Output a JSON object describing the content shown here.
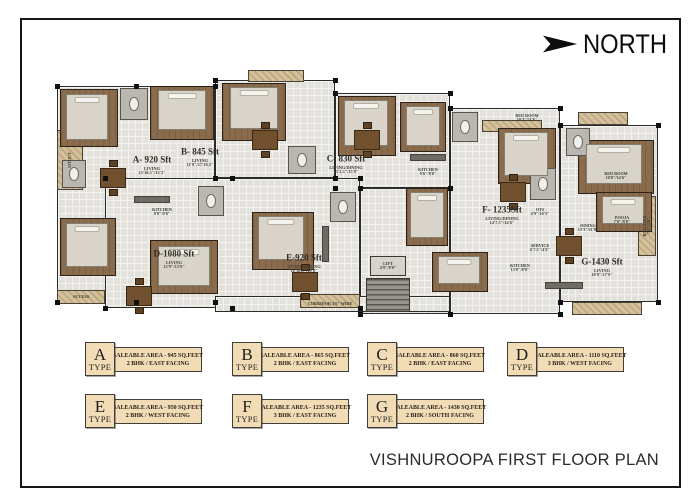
{
  "north": {
    "label": "NORTH"
  },
  "title": "VISHNUROOPA FIRST FLOOR PLAN",
  "plan": {
    "slabs": [
      {
        "x": 57,
        "y": 86,
        "w": 158,
        "h": 216
      },
      {
        "x": 215,
        "y": 80,
        "w": 120,
        "h": 98
      },
      {
        "x": 335,
        "y": 93,
        "w": 115,
        "h": 95
      },
      {
        "x": 105,
        "y": 178,
        "w": 255,
        "h": 130
      },
      {
        "x": 360,
        "y": 188,
        "w": 90,
        "h": 126
      },
      {
        "x": 450,
        "y": 108,
        "w": 110,
        "h": 206
      },
      {
        "x": 560,
        "y": 125,
        "w": 98,
        "h": 177
      }
    ],
    "corridor": {
      "x": 215,
      "y": 296,
      "w": 235,
      "h": 16
    },
    "balconies": [
      {
        "x": 57,
        "y": 130,
        "w": 26,
        "h": 60
      },
      {
        "x": 57,
        "y": 290,
        "w": 48,
        "h": 14
      },
      {
        "x": 248,
        "y": 70,
        "w": 56,
        "h": 12
      },
      {
        "x": 300,
        "y": 294,
        "w": 60,
        "h": 14
      },
      {
        "x": 572,
        "y": 302,
        "w": 70,
        "h": 13
      },
      {
        "x": 638,
        "y": 196,
        "w": 18,
        "h": 60
      },
      {
        "x": 482,
        "y": 120,
        "w": 60,
        "h": 12
      },
      {
        "x": 578,
        "y": 112,
        "w": 50,
        "h": 13
      }
    ],
    "bedrooms": [
      {
        "x": 60,
        "y": 89,
        "w": 58,
        "h": 58
      },
      {
        "x": 150,
        "y": 86,
        "w": 64,
        "h": 54
      },
      {
        "x": 222,
        "y": 83,
        "w": 64,
        "h": 58
      },
      {
        "x": 338,
        "y": 96,
        "w": 58,
        "h": 60
      },
      {
        "x": 400,
        "y": 102,
        "w": 46,
        "h": 50
      },
      {
        "x": 498,
        "y": 128,
        "w": 58,
        "h": 56
      },
      {
        "x": 578,
        "y": 140,
        "w": 76,
        "h": 54
      },
      {
        "x": 60,
        "y": 218,
        "w": 56,
        "h": 58
      },
      {
        "x": 150,
        "y": 240,
        "w": 68,
        "h": 54
      },
      {
        "x": 252,
        "y": 212,
        "w": 62,
        "h": 58
      },
      {
        "x": 406,
        "y": 188,
        "w": 42,
        "h": 58
      },
      {
        "x": 432,
        "y": 252,
        "w": 56,
        "h": 40
      },
      {
        "x": 596,
        "y": 192,
        "w": 56,
        "h": 40
      }
    ],
    "beds": [
      {
        "x": 66,
        "y": 94,
        "w": 42,
        "h": 46
      },
      {
        "x": 158,
        "y": 90,
        "w": 48,
        "h": 40
      },
      {
        "x": 230,
        "y": 87,
        "w": 48,
        "h": 42
      },
      {
        "x": 344,
        "y": 100,
        "w": 44,
        "h": 46
      },
      {
        "x": 406,
        "y": 106,
        "w": 34,
        "h": 40
      },
      {
        "x": 504,
        "y": 132,
        "w": 44,
        "h": 44
      },
      {
        "x": 586,
        "y": 144,
        "w": 56,
        "h": 40
      },
      {
        "x": 66,
        "y": 223,
        "w": 42,
        "h": 44
      },
      {
        "x": 158,
        "y": 246,
        "w": 52,
        "h": 40
      },
      {
        "x": 258,
        "y": 216,
        "w": 46,
        "h": 44
      },
      {
        "x": 410,
        "y": 192,
        "w": 34,
        "h": 46
      },
      {
        "x": 438,
        "y": 256,
        "w": 42,
        "h": 28
      },
      {
        "x": 602,
        "y": 196,
        "w": 42,
        "h": 28
      }
    ],
    "toilets": [
      {
        "x": 120,
        "y": 88,
        "w": 28,
        "h": 32
      },
      {
        "x": 288,
        "y": 146,
        "w": 28,
        "h": 28
      },
      {
        "x": 452,
        "y": 112,
        "w": 26,
        "h": 30
      },
      {
        "x": 530,
        "y": 168,
        "w": 26,
        "h": 32
      },
      {
        "x": 198,
        "y": 186,
        "w": 26,
        "h": 30
      },
      {
        "x": 330,
        "y": 192,
        "w": 26,
        "h": 30
      },
      {
        "x": 566,
        "y": 128,
        "w": 24,
        "h": 28
      },
      {
        "x": 62,
        "y": 160,
        "w": 24,
        "h": 28
      }
    ],
    "tables": [
      {
        "x": 100,
        "y": 168
      },
      {
        "x": 252,
        "y": 130
      },
      {
        "x": 354,
        "y": 130
      },
      {
        "x": 126,
        "y": 286
      },
      {
        "x": 292,
        "y": 272
      },
      {
        "x": 500,
        "y": 182
      },
      {
        "x": 556,
        "y": 236
      }
    ],
    "counters": [
      {
        "x": 410,
        "y": 154,
        "w": 36,
        "h": 7
      },
      {
        "x": 545,
        "y": 282,
        "w": 38,
        "h": 7
      },
      {
        "x": 134,
        "y": 196,
        "w": 36,
        "h": 7
      },
      {
        "x": 322,
        "y": 226,
        "w": 7,
        "h": 36
      }
    ],
    "stair": {
      "x": 366,
      "y": 278,
      "w": 44,
      "h": 34
    },
    "lift": {
      "x": 370,
      "y": 256,
      "w": 36,
      "h": 20
    },
    "units": [
      {
        "id": "A",
        "label": "A- 920 Sft",
        "sub": "LIVING\n15'10.5\"/15'3\"",
        "x": 152,
        "y": 160
      },
      {
        "id": "B",
        "label": "B- 845 Sft",
        "sub": "LIVING\n11'9\"/17'10.5\"",
        "x": 200,
        "y": 152
      },
      {
        "id": "C",
        "label": "C- 830 Sft",
        "sub": "LIVING/DINING\n13'1.5\"/15'9\"",
        "x": 346,
        "y": 159
      },
      {
        "id": "D",
        "label": "D-1080 Sft",
        "sub": "LIVING\n13'9\"/13'0\"",
        "x": 174,
        "y": 254
      },
      {
        "id": "E",
        "label": "E-920 Sft",
        "sub": "LIVING/DINING\n16'10.5\"/10'0\"",
        "x": 304,
        "y": 258
      },
      {
        "id": "F",
        "label": "F- 1235Sft",
        "sub": "LIVING/DINING\n14'7.5\"/14'6\"",
        "x": 502,
        "y": 210
      },
      {
        "id": "G",
        "label": "G-1430 Sft",
        "sub": "LIVING\n18'0\"/17'9\"",
        "x": 602,
        "y": 262
      }
    ],
    "rooms": [
      {
        "text": "KITCHEN\n13'0\"/8'0\"",
        "x": 520,
        "y": 268
      },
      {
        "text": "DINING\n13'3\"/11'9\"",
        "x": 588,
        "y": 228
      },
      {
        "text": "POOJA\n7'0\"/8'0\"",
        "x": 622,
        "y": 220
      },
      {
        "text": "OTS\n4'9\"/10'3\"",
        "x": 540,
        "y": 212
      },
      {
        "text": "SERVICE\n6'7.5\"/4'0\"",
        "x": 540,
        "y": 248
      },
      {
        "text": "BED ROOM\n10'3\"/11'6\"",
        "x": 527,
        "y": 118
      },
      {
        "text": "BED ROOM\n10'0\"/14'6\"",
        "x": 616,
        "y": 176
      },
      {
        "text": "LIFT\n4'9\"/8'0\"",
        "x": 388,
        "y": 266
      },
      {
        "text": "CORRIDOR 4'6\" WIDE",
        "x": 330,
        "y": 304
      },
      {
        "text": "ACCESS",
        "x": 81,
        "y": 297
      },
      {
        "text": "SITOUT",
        "x": 70,
        "y": 160,
        "v": true
      },
      {
        "text": "BALCONY\n7'3\"/3'0\"",
        "x": 647,
        "y": 226,
        "v": true
      },
      {
        "text": "KITCHEN\n9'6\"/8'0\"",
        "x": 428,
        "y": 172
      },
      {
        "text": "KITCHEN\n8'0\"/9'6\"",
        "x": 162,
        "y": 212
      }
    ]
  },
  "legend": {
    "type_word": "TYPE",
    "rows": [
      {
        "y": 342,
        "items": [
          {
            "letter": "A",
            "area": "SALEABLE AREA - 945 SQ.FEET",
            "facing": "2 BHK / EAST FACING",
            "x": 85
          },
          {
            "letter": "B",
            "area": "SALEABLE AREA - 865 SQ.FEET",
            "facing": "2 BHK / EAST FACING",
            "x": 232
          },
          {
            "letter": "C",
            "area": "SALEABLE AREA - 860 SQ.FEET",
            "facing": "2 BHK / EAST FACING",
            "x": 367
          },
          {
            "letter": "D",
            "area": "SALEABLE AREA - 1110 SQ.FEET",
            "facing": "3 BHK / WEST FACING",
            "x": 507
          }
        ]
      },
      {
        "y": 394,
        "items": [
          {
            "letter": "E",
            "area": "SALEABLE AREA - 950 SQ.FEET",
            "facing": "2 BHK / WEST FACING",
            "x": 85
          },
          {
            "letter": "F",
            "area": "SALEABLE AREA - 1235 SQ.FEET",
            "facing": "3 BHK / EAST FACING",
            "x": 232
          },
          {
            "letter": "G",
            "area": "SALEABLE AREA - 1430 SQ.FEET",
            "facing": "2 BHK / SOUTH FACING",
            "x": 367
          }
        ]
      }
    ]
  },
  "colors": {
    "wall": "#2b2b2b",
    "tile": "#e3e1dc",
    "wood": "#8a6b4c",
    "balcony": "#d4c09a",
    "legend_fill": "#f2dcb6",
    "accent_text": "#2a2118"
  }
}
